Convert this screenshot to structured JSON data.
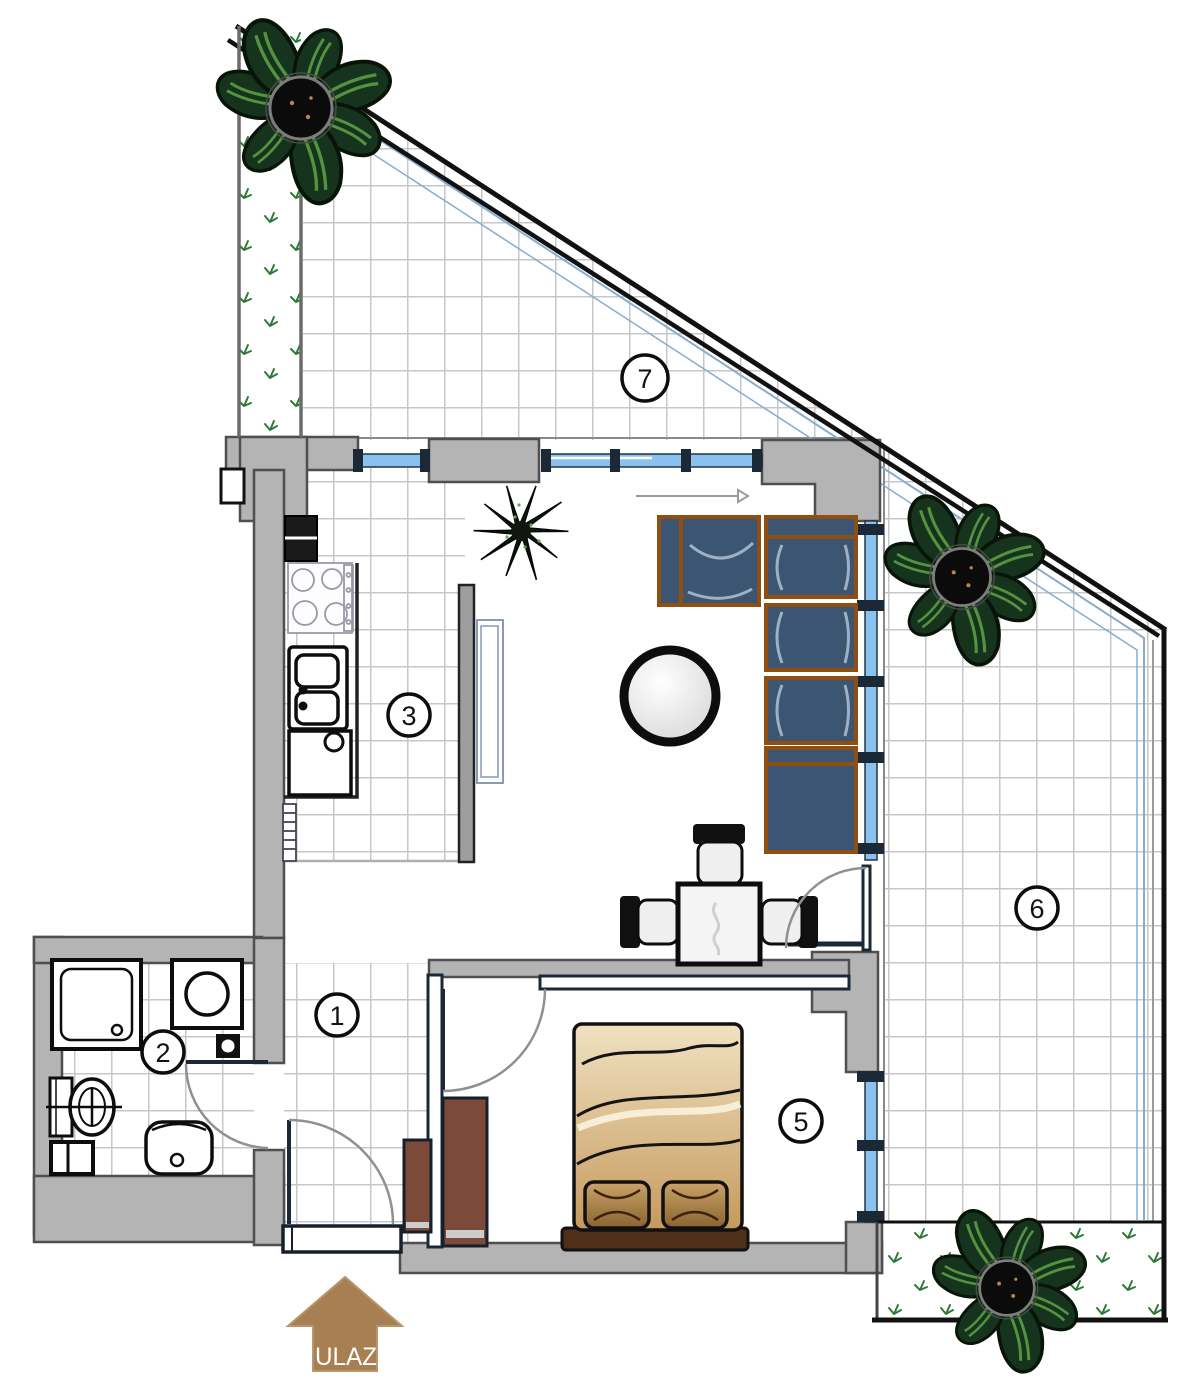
{
  "title": "apartment-floor-plan",
  "entrance": {
    "label": "ULAZ"
  },
  "rooms": {
    "hallway": {
      "number": "1"
    },
    "bathroom": {
      "number": "2"
    },
    "kitchen": {
      "number": "3"
    },
    "bedroom": {
      "number": "5"
    },
    "terrace_right": {
      "number": "6"
    },
    "terrace_top": {
      "number": "7"
    }
  },
  "colors": {
    "wall_fill": "#b4b4b4",
    "wall_stroke": "#4f4f4f",
    "glass": "#8ac1ef",
    "window_frame": "#1b2936",
    "tile_line": "#c7c7c7",
    "sofa": "#3c5573",
    "sofa_trim": "#8f4e12",
    "bed_light": "#f0e2c2",
    "bed_dark": "#c6995d",
    "wardrobe": "#7b4a38",
    "plant_leaf": "#16331d",
    "grass": "#2e7b38",
    "entrance_arrow": "#a87f52"
  }
}
